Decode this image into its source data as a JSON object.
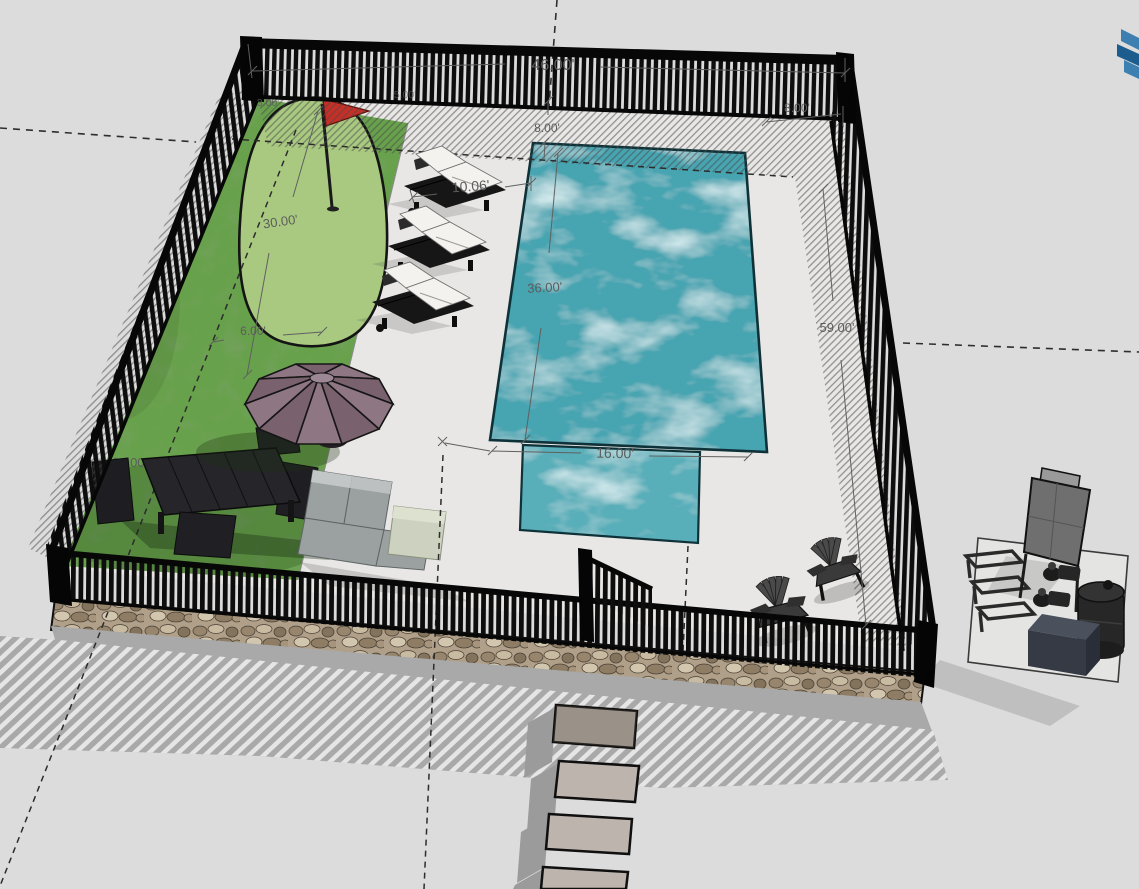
{
  "app": {
    "icons": {
      "watermark_logo": "sketchup-logo"
    }
  },
  "colors": {
    "background": "#dcdcdc",
    "patio": "#e8e7e5",
    "lawn": "#68a14c",
    "putting_green": "#a9c981",
    "pool_water": "#46a4b1",
    "pool_ledge": "#58aeb9",
    "flag": "#c52f26",
    "fence": "#0d0d0d",
    "stone_wall": "#b1a089",
    "paver": "#bdb4ad",
    "umbrella": "#8e7683",
    "umbrella_dark": "#7a616e",
    "cushion": "#f3f2ee",
    "sofa": "#9ba1a1",
    "ottoman": "#ccd2bf",
    "dimension": "#5c5c5c",
    "logo_blue": "#3e7fb1",
    "logo_blue_dark": "#1c5d8e"
  },
  "dimensions": {
    "overall_width": "46.00'",
    "overall_depth": "59.00'",
    "pool_length": "36.00'",
    "pool_width": "16.00'",
    "lounge_deck_width": "10.06'",
    "setback_left": "8.00'",
    "setback_right": "8.00'",
    "putting_green_length": "30.00'",
    "putting_green_width": "6.00'",
    "green_offset_left": "3.00'",
    "green_offset_right": "5.00'",
    "side_dimension": "24.00'"
  }
}
